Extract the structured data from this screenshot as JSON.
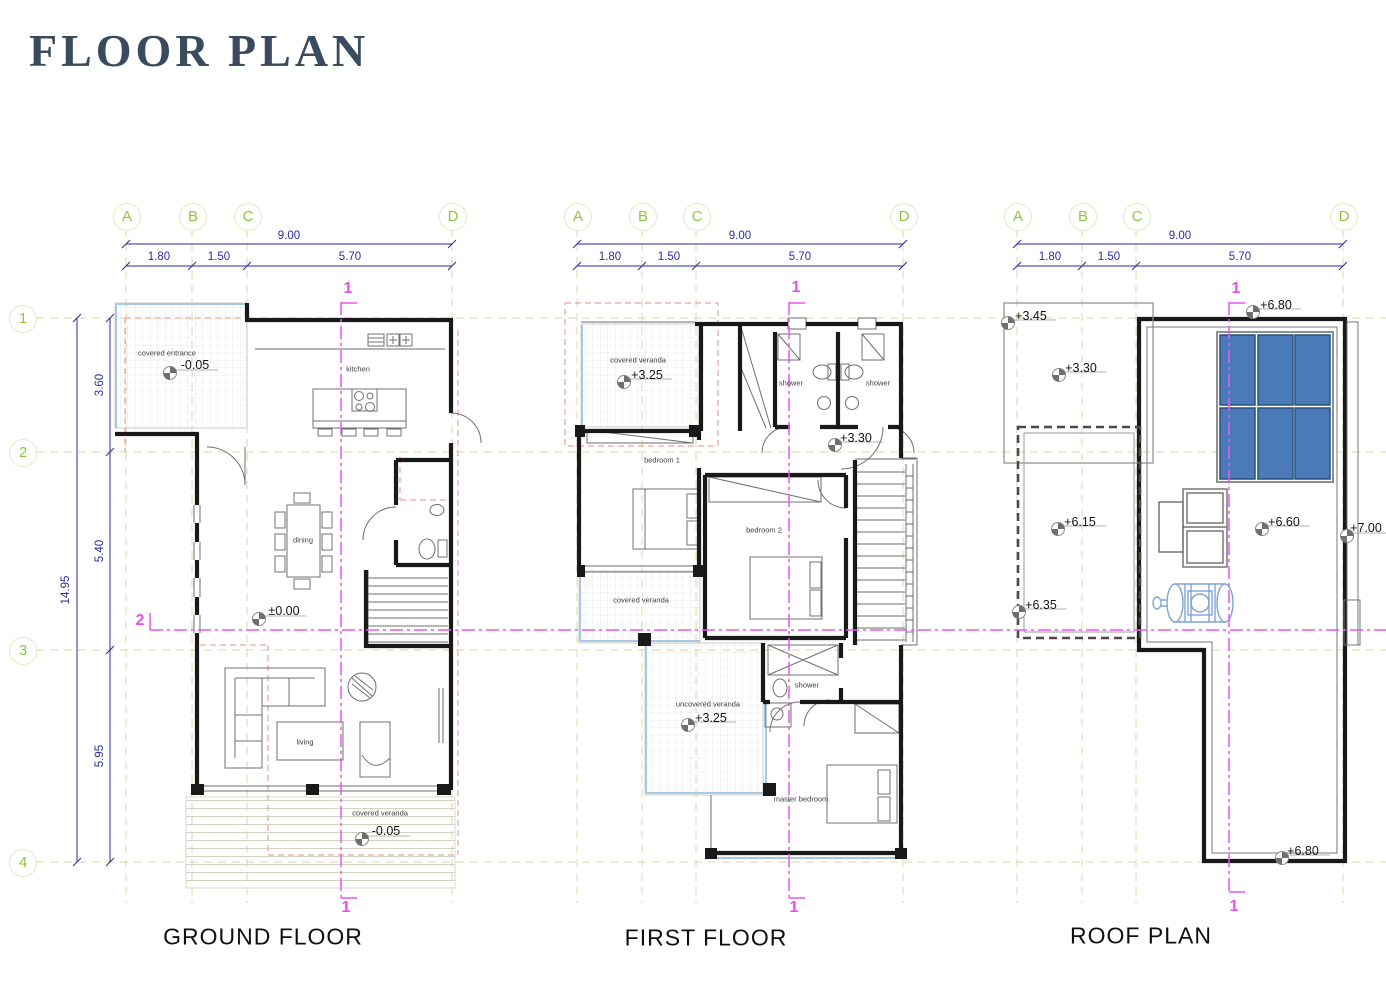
{
  "title": "FLOOR PLAN",
  "rows": {
    "labels": [
      "1",
      "2",
      "3",
      "4"
    ],
    "dim_total": "14.95",
    "dim_segments": [
      "3.60",
      "5.40",
      "5.95"
    ]
  },
  "sections": {
    "vertical": "1",
    "horizontal": "2"
  },
  "plans": [
    {
      "name": "GROUND FLOOR",
      "grid": [
        "A",
        "B",
        "C",
        "D"
      ],
      "dim_total": "9.00",
      "dim_segments": [
        "1.80",
        "1.50",
        "5.70"
      ],
      "rooms": [
        "covered entrance",
        "kitchen",
        "dining",
        "living",
        "covered veranda"
      ],
      "levels": [
        "-0.05",
        "±0.00",
        "-0.05"
      ]
    },
    {
      "name": "FIRST FLOOR",
      "grid": [
        "A",
        "B",
        "C",
        "D"
      ],
      "dim_total": "9.00",
      "dim_segments": [
        "1.80",
        "1.50",
        "5.70"
      ],
      "rooms": [
        "covered veranda",
        "shower",
        "shower",
        "bedroom 1",
        "bedroom 2",
        "covered veranda",
        "shower",
        "uncovered veranda",
        "master bedroom"
      ],
      "levels": [
        "+3.25",
        "+3.30",
        "+3.25"
      ]
    },
    {
      "name": "ROOF PLAN",
      "grid": [
        "A",
        "B",
        "C",
        "D"
      ],
      "dim_total": "9.00",
      "dim_segments": [
        "1.80",
        "1.50",
        "5.70"
      ],
      "rooms": [],
      "levels": [
        "+3.45",
        "+3.30",
        "+6.80",
        "+6.15",
        "+6.35",
        "+6.60",
        "+7.00",
        "+6.80"
      ]
    }
  ],
  "colors": {
    "title": "#3a4a5f",
    "grid_marker_green": "#8fc640",
    "dimension_navy": "#2b2b9e",
    "section_magenta": "#e94fe8",
    "overlay_salmon": "#eba49e",
    "grid_line_khaki": "#d9d9a8",
    "wall_black": "#191919",
    "solar_panel_blue": "#4a7ab8",
    "water_tank_blue": "#7fa3d8",
    "veranda_edge_blue": "#a9c9e2"
  }
}
